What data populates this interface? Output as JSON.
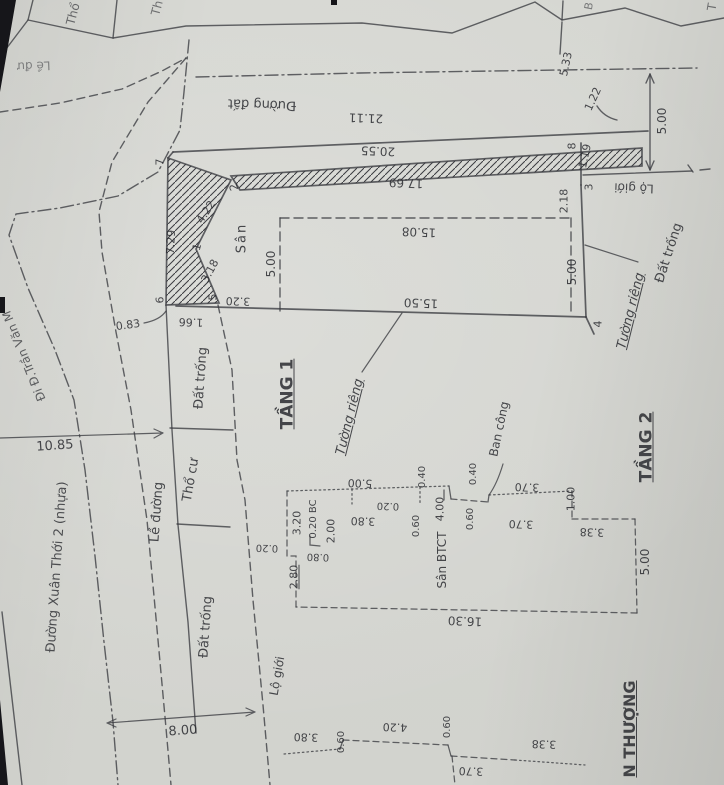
{
  "palette": {
    "paper": "#d6d7d2",
    "ink": "#3a3b40",
    "text": "#2b2c31"
  },
  "labels": [
    {
      "id": "parcel-letter-tho",
      "text": "Thổ",
      "x": 73,
      "y": 14,
      "r": -75,
      "fs": 12,
      "op": 0.65
    },
    {
      "id": "parcel-letter-th",
      "text": "Th",
      "x": 157,
      "y": 8,
      "r": -75,
      "fs": 12,
      "op": 0.6
    },
    {
      "id": "parcel-letter-b",
      "text": "B",
      "x": 589,
      "y": 6,
      "r": -80,
      "fs": 11,
      "op": 0.55
    },
    {
      "id": "parcel-letter-t",
      "text": "T",
      "x": 712,
      "y": 7,
      "r": -80,
      "fs": 12,
      "op": 0.6
    },
    {
      "id": "le-duong-top",
      "text": "Lề đư",
      "x": 34,
      "y": 66,
      "r": 178,
      "fs": 12,
      "op": 0.5
    },
    {
      "id": "duong-dat",
      "text": "Đường đất",
      "x": 262,
      "y": 104,
      "r": 182,
      "fs": 13
    },
    {
      "id": "dim-21-11",
      "text": "21.11",
      "x": 366,
      "y": 118,
      "r": 182,
      "fs": 12
    },
    {
      "id": "dim-5-33",
      "text": "5.33",
      "x": 566,
      "y": 64,
      "r": -78,
      "fs": 11
    },
    {
      "id": "dim-1-22",
      "text": "1.22",
      "x": 593,
      "y": 99,
      "r": -65,
      "fs": 11
    },
    {
      "id": "dim-5-00-ne",
      "text": "5.00",
      "x": 662,
      "y": 121,
      "r": -90,
      "fs": 12
    },
    {
      "id": "lo-gioi-ne",
      "text": "Lộ giới",
      "x": 634,
      "y": 188,
      "r": 182,
      "fs": 12
    },
    {
      "id": "dim-20-55",
      "text": "20.55",
      "x": 378,
      "y": 151,
      "r": 182,
      "fs": 12
    },
    {
      "id": "dim-17-69",
      "text": "17.69",
      "x": 406,
      "y": 183,
      "r": 182,
      "fs": 12
    },
    {
      "id": "pt-8",
      "text": "8",
      "x": 572,
      "y": 146,
      "r": -90,
      "fs": 11
    },
    {
      "id": "dim-1-19",
      "text": "1.19",
      "x": 585,
      "y": 156,
      "r": -78,
      "fs": 11
    },
    {
      "id": "pt-3",
      "text": "3",
      "x": 589,
      "y": 187,
      "r": -90,
      "fs": 11
    },
    {
      "id": "dim-2-18",
      "text": "2.18",
      "x": 564,
      "y": 201,
      "r": -90,
      "fs": 11
    },
    {
      "id": "pt-7",
      "text": "7",
      "x": 160,
      "y": 162,
      "r": -90,
      "fs": 11
    },
    {
      "id": "pt-2",
      "text": "2",
      "x": 234,
      "y": 187,
      "r": -105,
      "fs": 11
    },
    {
      "id": "dim-4-22",
      "text": "4.22",
      "x": 206,
      "y": 212,
      "r": -57,
      "fs": 11
    },
    {
      "id": "pt-1",
      "text": "1",
      "x": 197,
      "y": 247,
      "r": -75,
      "fs": 11
    },
    {
      "id": "dim-3-18",
      "text": "3.18",
      "x": 210,
      "y": 271,
      "r": -62,
      "fs": 11
    },
    {
      "id": "dim-7-29",
      "text": "7.29",
      "x": 171,
      "y": 242,
      "r": -87,
      "fs": 11
    },
    {
      "id": "pt-6",
      "text": "6",
      "x": 160,
      "y": 300,
      "r": -90,
      "fs": 11
    },
    {
      "id": "pt-5",
      "text": "5",
      "x": 213,
      "y": 297,
      "r": -90,
      "fs": 11
    },
    {
      "id": "dim-3-20",
      "text": "3.20",
      "x": 238,
      "y": 301,
      "r": 182,
      "fs": 11
    },
    {
      "id": "dim-1-66",
      "text": "1.66",
      "x": 191,
      "y": 322,
      "r": 182,
      "fs": 11
    },
    {
      "id": "dim-0-83",
      "text": "0.83",
      "x": 128,
      "y": 325,
      "r": -8,
      "fs": 11
    },
    {
      "id": "san",
      "text": "Sân",
      "x": 242,
      "y": 238,
      "r": -90,
      "fs": 13,
      "ls": 2
    },
    {
      "id": "dim-5-00-rect",
      "text": "5.00",
      "x": 271,
      "y": 264,
      "r": -90,
      "fs": 12
    },
    {
      "id": "dim-15-08",
      "text": "15.08",
      "x": 419,
      "y": 232,
      "r": 182,
      "fs": 12
    },
    {
      "id": "dim-15-50",
      "text": "15.50",
      "x": 421,
      "y": 303,
      "r": 182,
      "fs": 12
    },
    {
      "id": "dim-5-00-e",
      "text": "5.00",
      "x": 572,
      "y": 272,
      "r": -90,
      "fs": 12
    },
    {
      "id": "pt-4",
      "text": "4",
      "x": 598,
      "y": 324,
      "r": -90,
      "fs": 11
    },
    {
      "id": "tuong-rieng-e",
      "text": "Tường riêng",
      "x": 631,
      "y": 311,
      "r": -76,
      "fs": 13,
      "i": 1,
      "u": 1
    },
    {
      "id": "dat-trong-e",
      "text": "Đất trống",
      "x": 669,
      "y": 253,
      "r": -72,
      "fs": 13
    },
    {
      "id": "dat-trong-w1",
      "text": "Đất trống",
      "x": 201,
      "y": 378,
      "r": -86,
      "fs": 13
    },
    {
      "id": "tho-cu",
      "text": "Thổ cư",
      "x": 191,
      "y": 480,
      "r": -80,
      "fs": 13
    },
    {
      "id": "le-duong",
      "text": "Lề đường",
      "x": 157,
      "y": 512,
      "r": -86,
      "fs": 13
    },
    {
      "id": "dat-trong-w2",
      "text": "Đất trống",
      "x": 206,
      "y": 627,
      "r": -86,
      "fs": 13
    },
    {
      "id": "street-xuan-thoi-2",
      "text": "Đường Xuân Thới 2 (nhựa)",
      "x": 57,
      "y": 567,
      "r": -86,
      "fs": 13,
      "op": 0.8
    },
    {
      "id": "street-di-tran-van",
      "text": "Đi Đ.Trần Văn M",
      "x": 24,
      "y": 356,
      "r": -112,
      "fs": 12,
      "op": 0.7
    },
    {
      "id": "dim-10-85",
      "text": "10.85",
      "x": 55,
      "y": 446,
      "r": -4,
      "fs": 13
    },
    {
      "id": "tang-1",
      "text": "TẦNG 1",
      "x": 288,
      "y": 394,
      "r": -90,
      "fs": 17,
      "b": 1,
      "u": 1
    },
    {
      "id": "tuong-rieng-mid",
      "text": "Tường riêng",
      "x": 350,
      "y": 417,
      "r": -76,
      "fs": 13,
      "i": 1,
      "u": 1
    },
    {
      "id": "dim-8-00",
      "text": "8.00",
      "x": 183,
      "y": 731,
      "r": -4,
      "fs": 13
    },
    {
      "id": "lo-gioi-s",
      "text": "Lộ giới",
      "x": 277,
      "y": 676,
      "r": -80,
      "fs": 12
    },
    {
      "id": "dim-16-30",
      "text": "16.30",
      "x": 465,
      "y": 621,
      "r": 182,
      "fs": 12
    },
    {
      "id": "dim-5-00-t2",
      "text": "5.00",
      "x": 645,
      "y": 562,
      "r": -90,
      "fs": 12
    },
    {
      "id": "dim-3-38-t2",
      "text": "3.38",
      "x": 592,
      "y": 532,
      "r": 182,
      "fs": 11
    },
    {
      "id": "dim-3-70-bc",
      "text": "3.70",
      "x": 527,
      "y": 487,
      "r": 182,
      "fs": 11
    },
    {
      "id": "dim-1-00",
      "text": "1.00",
      "x": 571,
      "y": 499,
      "r": -90,
      "fs": 11
    },
    {
      "id": "dim-3-70-t2",
      "text": "3.70",
      "x": 521,
      "y": 524,
      "r": 182,
      "fs": 11
    },
    {
      "id": "ban-cong",
      "text": "Ban công",
      "x": 499,
      "y": 429,
      "r": -78,
      "fs": 12
    },
    {
      "id": "dim-0-40-bc",
      "text": "0.40",
      "x": 474,
      "y": 474,
      "r": -90,
      "fs": 10
    },
    {
      "id": "dim-0-60-bc",
      "text": "0.60",
      "x": 471,
      "y": 519,
      "r": -90,
      "fs": 10
    },
    {
      "id": "dim-4-00",
      "text": "4.00",
      "x": 440,
      "y": 509,
      "r": -90,
      "fs": 11
    },
    {
      "id": "dim-0-40-m",
      "text": "0.40",
      "x": 423,
      "y": 477,
      "r": -90,
      "fs": 10
    },
    {
      "id": "dim-0-60-m",
      "text": "0.60",
      "x": 417,
      "y": 526,
      "r": -90,
      "fs": 10
    },
    {
      "id": "dim-5-00-n",
      "text": "5.00",
      "x": 360,
      "y": 483,
      "r": 182,
      "fs": 11
    },
    {
      "id": "dim-0-20-n",
      "text": "0.20",
      "x": 388,
      "y": 505,
      "r": 182,
      "fs": 10
    },
    {
      "id": "dim-3-80-t1",
      "text": "3.80",
      "x": 363,
      "y": 521,
      "r": 182,
      "fs": 11
    },
    {
      "id": "dim-3-20-w",
      "text": "3.20",
      "x": 297,
      "y": 523,
      "r": -90,
      "fs": 11
    },
    {
      "id": "dim-0-20-bc",
      "text": "0.20 BC",
      "x": 314,
      "y": 519,
      "r": -90,
      "fs": 10
    },
    {
      "id": "dim-2-00",
      "text": "2.00",
      "x": 331,
      "y": 531,
      "r": -90,
      "fs": 11
    },
    {
      "id": "dim-0-20-w",
      "text": "0.20",
      "x": 267,
      "y": 547,
      "r": 182,
      "fs": 10
    },
    {
      "id": "dim-0-80",
      "text": "0.80",
      "x": 318,
      "y": 556,
      "r": 182,
      "fs": 10
    },
    {
      "id": "dim-2-80",
      "text": "2.80",
      "x": 294,
      "y": 577,
      "r": -90,
      "fs": 11,
      "u": 1
    },
    {
      "id": "san-btct",
      "text": "Sân BTCT",
      "x": 442,
      "y": 560,
      "r": -90,
      "fs": 12
    },
    {
      "id": "tang-2",
      "text": "TẦNG 2",
      "x": 647,
      "y": 447,
      "r": -90,
      "fs": 17,
      "b": 1,
      "u": 1
    },
    {
      "id": "san-thuong",
      "text": "N THƯỢNG",
      "x": 630,
      "y": 729,
      "r": -90,
      "fs": 16,
      "b": 1,
      "u": 1
    },
    {
      "id": "dim-3-80-r",
      "text": "3.80",
      "x": 306,
      "y": 737,
      "r": 182,
      "fs": 11
    },
    {
      "id": "dim-0-60-r1",
      "text": "0.60",
      "x": 342,
      "y": 742,
      "r": -90,
      "fs": 10
    },
    {
      "id": "dim-4-20",
      "text": "4.20",
      "x": 395,
      "y": 727,
      "r": 182,
      "fs": 11
    },
    {
      "id": "dim-0-60-r2",
      "text": "0.60",
      "x": 448,
      "y": 727,
      "r": -90,
      "fs": 10
    },
    {
      "id": "dim-3-38-r",
      "text": "3.38",
      "x": 544,
      "y": 744,
      "r": 182,
      "fs": 11
    },
    {
      "id": "dim-3-70-r",
      "text": "3.70",
      "x": 471,
      "y": 771,
      "r": 182,
      "fs": 11
    }
  ]
}
